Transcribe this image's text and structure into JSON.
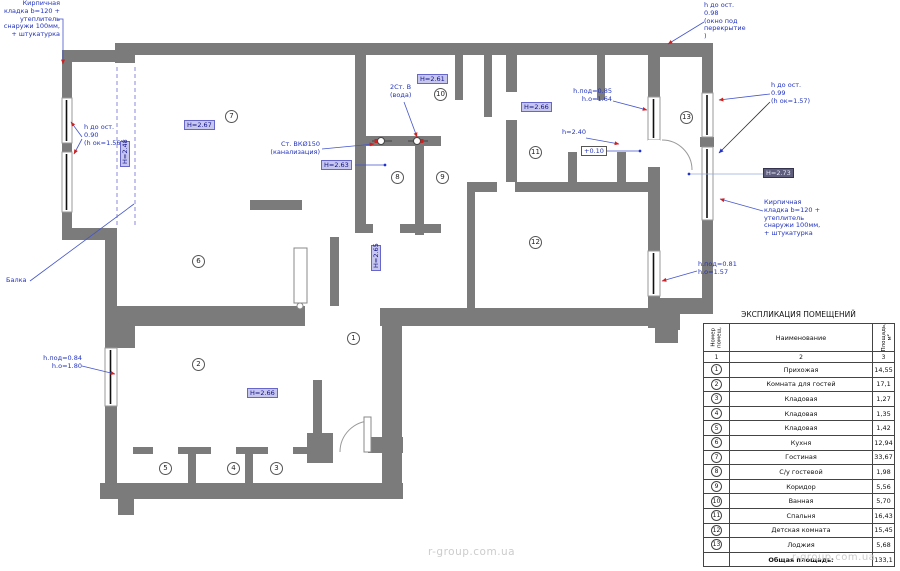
{
  "plan": {
    "annotations": {
      "brick_left": "Кирпичная\nкладка b=120 +\nутеплитель\nснаружи 100мм,\n+ штукатурка",
      "window_left": "h до ост.\n0.90\n(h ок=1.56)",
      "beam": "Балка",
      "sewer": "Ст. ВКØ150\n(канализация)",
      "water": "2Ст. В\n(вода)",
      "window_mid": "h.под=0.85\nh.о=1.64",
      "lintel": "h=2.40",
      "elevation": "+0.10",
      "window_top_right": "h до ост.\n0.98\n(окно под\nперекрытие\n)",
      "window_right": "h до ост.\n0.99\n(h ок=1.57)",
      "brick_right": "Кирпичная\nкладка b=120 +\nутеплитель\nснаружи 100мм,\n+ штукатурка",
      "window_right_low": "h.под=0.81\nh.о=1.57",
      "window_left_low": "h.под=0.84\nh.о=1.80"
    },
    "heights": {
      "h1": "H=2.48",
      "h2": "H=2.67",
      "h3": "H=2.61",
      "h4": "H=2.63",
      "h5": "H=2.66",
      "h6": "H=2.73",
      "h7": "H=2.66",
      "h8": "H=2.65"
    },
    "rooms": [
      "1",
      "2",
      "3",
      "4",
      "5",
      "6",
      "7",
      "8",
      "9",
      "10",
      "11",
      "12",
      "13"
    ]
  },
  "table": {
    "title": "ЭКСПЛИКАЦИЯ ПОМЕЩЕНИЙ",
    "headers": {
      "num": "Номер\nпомещ.",
      "name": "Наименование",
      "area": "Площадь, м²"
    },
    "col_numbers": [
      "1",
      "2",
      "3"
    ],
    "rows": [
      {
        "num": "1",
        "name": "Прихожая",
        "area": "14,55"
      },
      {
        "num": "2",
        "name": "Комната для гостей",
        "area": "17,1"
      },
      {
        "num": "3",
        "name": "Кладовая",
        "area": "1,27"
      },
      {
        "num": "4",
        "name": "Кладовая",
        "area": "1,35"
      },
      {
        "num": "5",
        "name": "Кладовая",
        "area": "1,42"
      },
      {
        "num": "6",
        "name": "Кухня",
        "area": "12,94"
      },
      {
        "num": "7",
        "name": "Гостиная",
        "area": "33,67"
      },
      {
        "num": "8",
        "name": "С/у гостевой",
        "area": "1,98"
      },
      {
        "num": "9",
        "name": "Коридор",
        "area": "5,56"
      },
      {
        "num": "10",
        "name": "Ванная",
        "area": "5,70"
      },
      {
        "num": "11",
        "name": "Спальня",
        "area": "16,43"
      },
      {
        "num": "12",
        "name": "Детская комната",
        "area": "15,45"
      },
      {
        "num": "13",
        "name": "Лоджия",
        "area": "5,68"
      }
    ],
    "total_label": "Общая площадь:",
    "total_area": "133,1"
  },
  "watermark": "r-group.com.ua",
  "colors": {
    "wall": "#7b7b7b",
    "annotation": "#2233bb",
    "highlight": "#c7c7ee"
  }
}
